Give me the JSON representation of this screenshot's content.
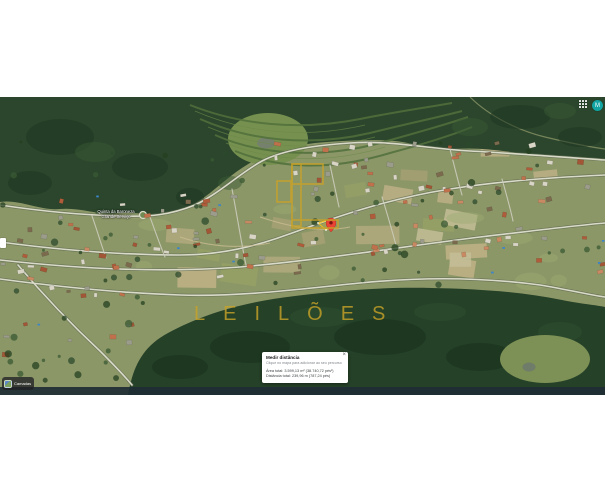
{
  "topbar": {
    "avatar_letter": "M"
  },
  "map": {
    "poi_label_line1": "Quinta da Baroneza",
    "poi_label_line2": "Grande Serviço"
  },
  "watermark": {
    "brand_word": "LEILÕES"
  },
  "measure_dialog": {
    "title": "Medir distância",
    "close": "×",
    "subtitle": "Clique no mapa para adicionar ao seu percurso",
    "area_total": "Área total: 3.599,13 m² (38.740,72 pés²)",
    "distance_total": "Distância total: 239,96 m (787,24 pés)"
  },
  "layers_control": {
    "label": "Camadas"
  },
  "colors": {
    "accent_gold": "#c9a227",
    "pin_red": "#ea4335",
    "avatar_teal": "#12a5a3"
  }
}
